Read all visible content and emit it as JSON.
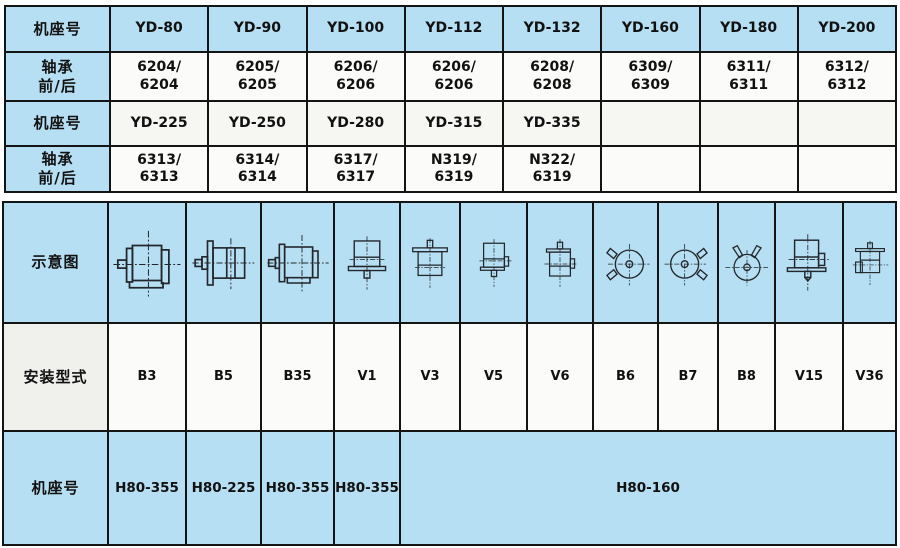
{
  "colors": {
    "cell_blue": "#b6dff3",
    "cell_white": "#fbfbf9",
    "cell_gray": "#f0f0ed",
    "border": "#141414",
    "text": "#111111"
  },
  "bearing_table": {
    "rows": [
      {
        "label": "机座号",
        "cells": [
          "YD-80",
          "YD-90",
          "YD-100",
          "YD-112",
          "YD-132",
          "YD-160",
          "YD-180",
          "YD-200"
        ]
      },
      {
        "label": "轴承\n前/后",
        "cells": [
          "6204/\n6204",
          "6205/\n6205",
          "6206/\n6206",
          "6206/\n6206",
          "6208/\n6208",
          "6309/\n6309",
          "6311/\n6311",
          "6312/\n6312"
        ]
      },
      {
        "label": "机座号",
        "cells": [
          "YD-225",
          "YD-250",
          "YD-280",
          "YD-315",
          "YD-335",
          "",
          "",
          ""
        ]
      },
      {
        "label": "轴承\n前/后",
        "cells": [
          "6313/\n6313",
          "6314/\n6314",
          "6317/\n6317",
          "N319/\n6319",
          "N322/\n6319",
          "",
          "",
          ""
        ]
      }
    ]
  },
  "mounting_table": {
    "diagram_label": "示意图",
    "mount_label": "安装型式",
    "frame_label": "机座号",
    "mount_types": [
      "B3",
      "B5",
      "B35",
      "V1",
      "V3",
      "V5",
      "V6",
      "B6",
      "B7",
      "B8",
      "V15",
      "V36"
    ],
    "diagram_icons": [
      "motor-b3-foot-horizontal-icon",
      "motor-b5-flange-horizontal-icon",
      "motor-b35-foot-flange-icon",
      "motor-v1-flange-shaft-down-icon",
      "motor-v3-flange-shaft-up-icon",
      "motor-v5-foot-shaft-down-icon",
      "motor-v6-foot-shaft-up-icon",
      "motor-b6-endview-feet-left-icon",
      "motor-b7-endview-feet-right-icon",
      "motor-b8-endview-feet-top-icon",
      "motor-v15-foot-flange-shaft-down-icon",
      "motor-v36-foot-flange-shaft-up-icon"
    ],
    "frame_cells": [
      "H80-355",
      "H80-225",
      "H80-355",
      "H80-355"
    ],
    "frame_merged": "H80-160"
  }
}
